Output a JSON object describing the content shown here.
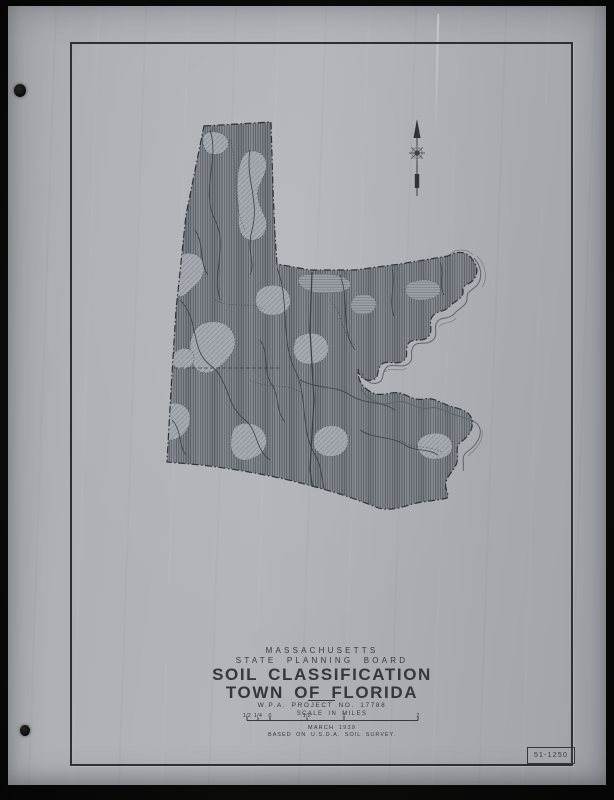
{
  "document": {
    "region_label": "MASSACHUSETTS",
    "board_label": "STATE PLANNING BOARD",
    "title_line1": "SOIL CLASSIFICATION",
    "title_line2": "TOWN OF FLORIDA",
    "project_label": "W.P.A. PROJECT NO. 17788",
    "date_label": "MARCH 1939",
    "source_label": "BASED ON U.S.D.A. SOIL SURVEY.",
    "sheet_number": "51-1250"
  },
  "scale_bar": {
    "title": "SCALE IN MILES",
    "labels": [
      "1/2",
      "1/4",
      "0",
      "1/2",
      "1",
      "2"
    ]
  },
  "map": {
    "subject": "Soil classification map of the Town of Florida, Massachusetts",
    "north_arrow": "north-arrow"
  },
  "colors": {
    "paper": "#aeb2b7",
    "ink": "#34383d",
    "border": "#2c3034",
    "map_base": "#858b91",
    "hatch_line": "#4a5056",
    "light_patch": "#a5aab0",
    "background": "#0a0a09"
  }
}
